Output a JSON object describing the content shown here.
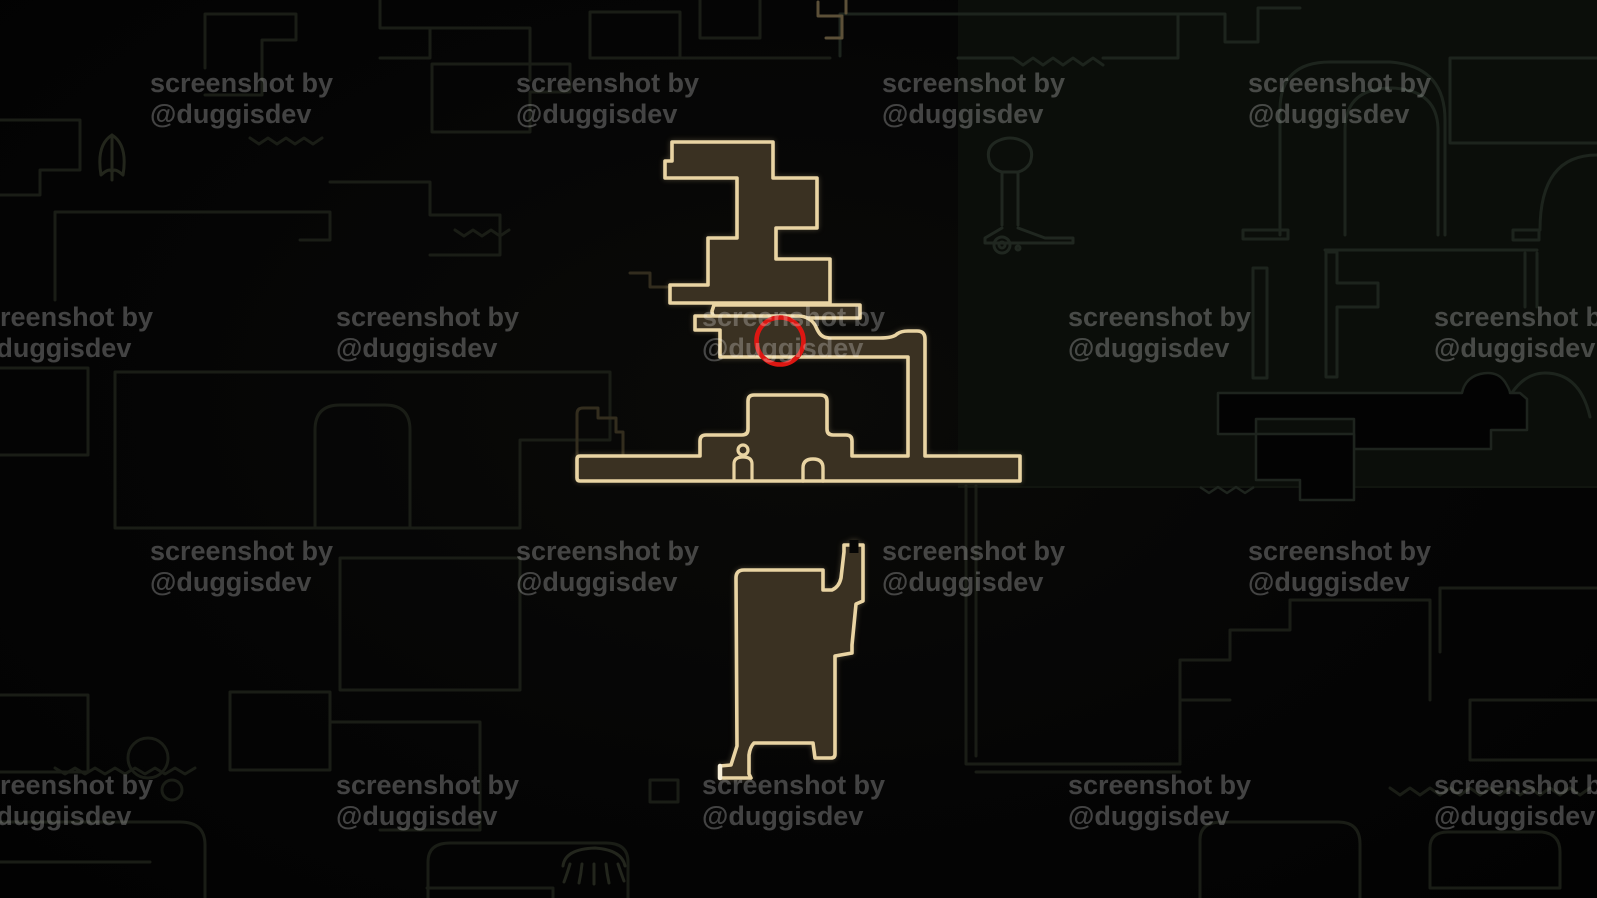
{
  "app": {
    "description": "dark game map screenshot with explored rooms highlighted and a red circle annotation"
  },
  "watermark": {
    "line1": "screenshot by",
    "line2": "@duggisdev",
    "color": "rgba(255,255,255,0.25)",
    "positions": [
      {
        "x": 150,
        "y": 68
      },
      {
        "x": 516,
        "y": 68
      },
      {
        "x": 882,
        "y": 68
      },
      {
        "x": 1248,
        "y": 68
      },
      {
        "x": -30,
        "y": 302
      },
      {
        "x": 336,
        "y": 302
      },
      {
        "x": 702,
        "y": 302
      },
      {
        "x": 1068,
        "y": 302
      },
      {
        "x": 1434,
        "y": 302
      },
      {
        "x": 150,
        "y": 536
      },
      {
        "x": 516,
        "y": 536
      },
      {
        "x": 882,
        "y": 536
      },
      {
        "x": 1248,
        "y": 536
      },
      {
        "x": -30,
        "y": 770
      },
      {
        "x": 336,
        "y": 770
      },
      {
        "x": 702,
        "y": 770
      },
      {
        "x": 1068,
        "y": 770
      },
      {
        "x": 1434,
        "y": 770
      }
    ]
  },
  "map": {
    "colors": {
      "background": "#050505",
      "explored_fill": "#3a3122",
      "explored_outline": "#e9d4a3",
      "unexplored_outline": "#1a1d16",
      "right_panel_tint": "#0b0e0a",
      "annotation_red": "#dc1712",
      "foot_cap_highlight": "#f6eed8"
    },
    "icons": [
      {
        "name": "figure-marker-icon"
      },
      {
        "name": "arch-marker-icon"
      },
      {
        "name": "statue-icon"
      },
      {
        "name": "spiral-shell-icon"
      },
      {
        "name": "jellyfish-icon"
      },
      {
        "name": "moth-icon"
      }
    ],
    "annotation": {
      "shape": "circle",
      "color": "#dc1712",
      "meaning": "red circle marking a location on the explored map"
    }
  }
}
